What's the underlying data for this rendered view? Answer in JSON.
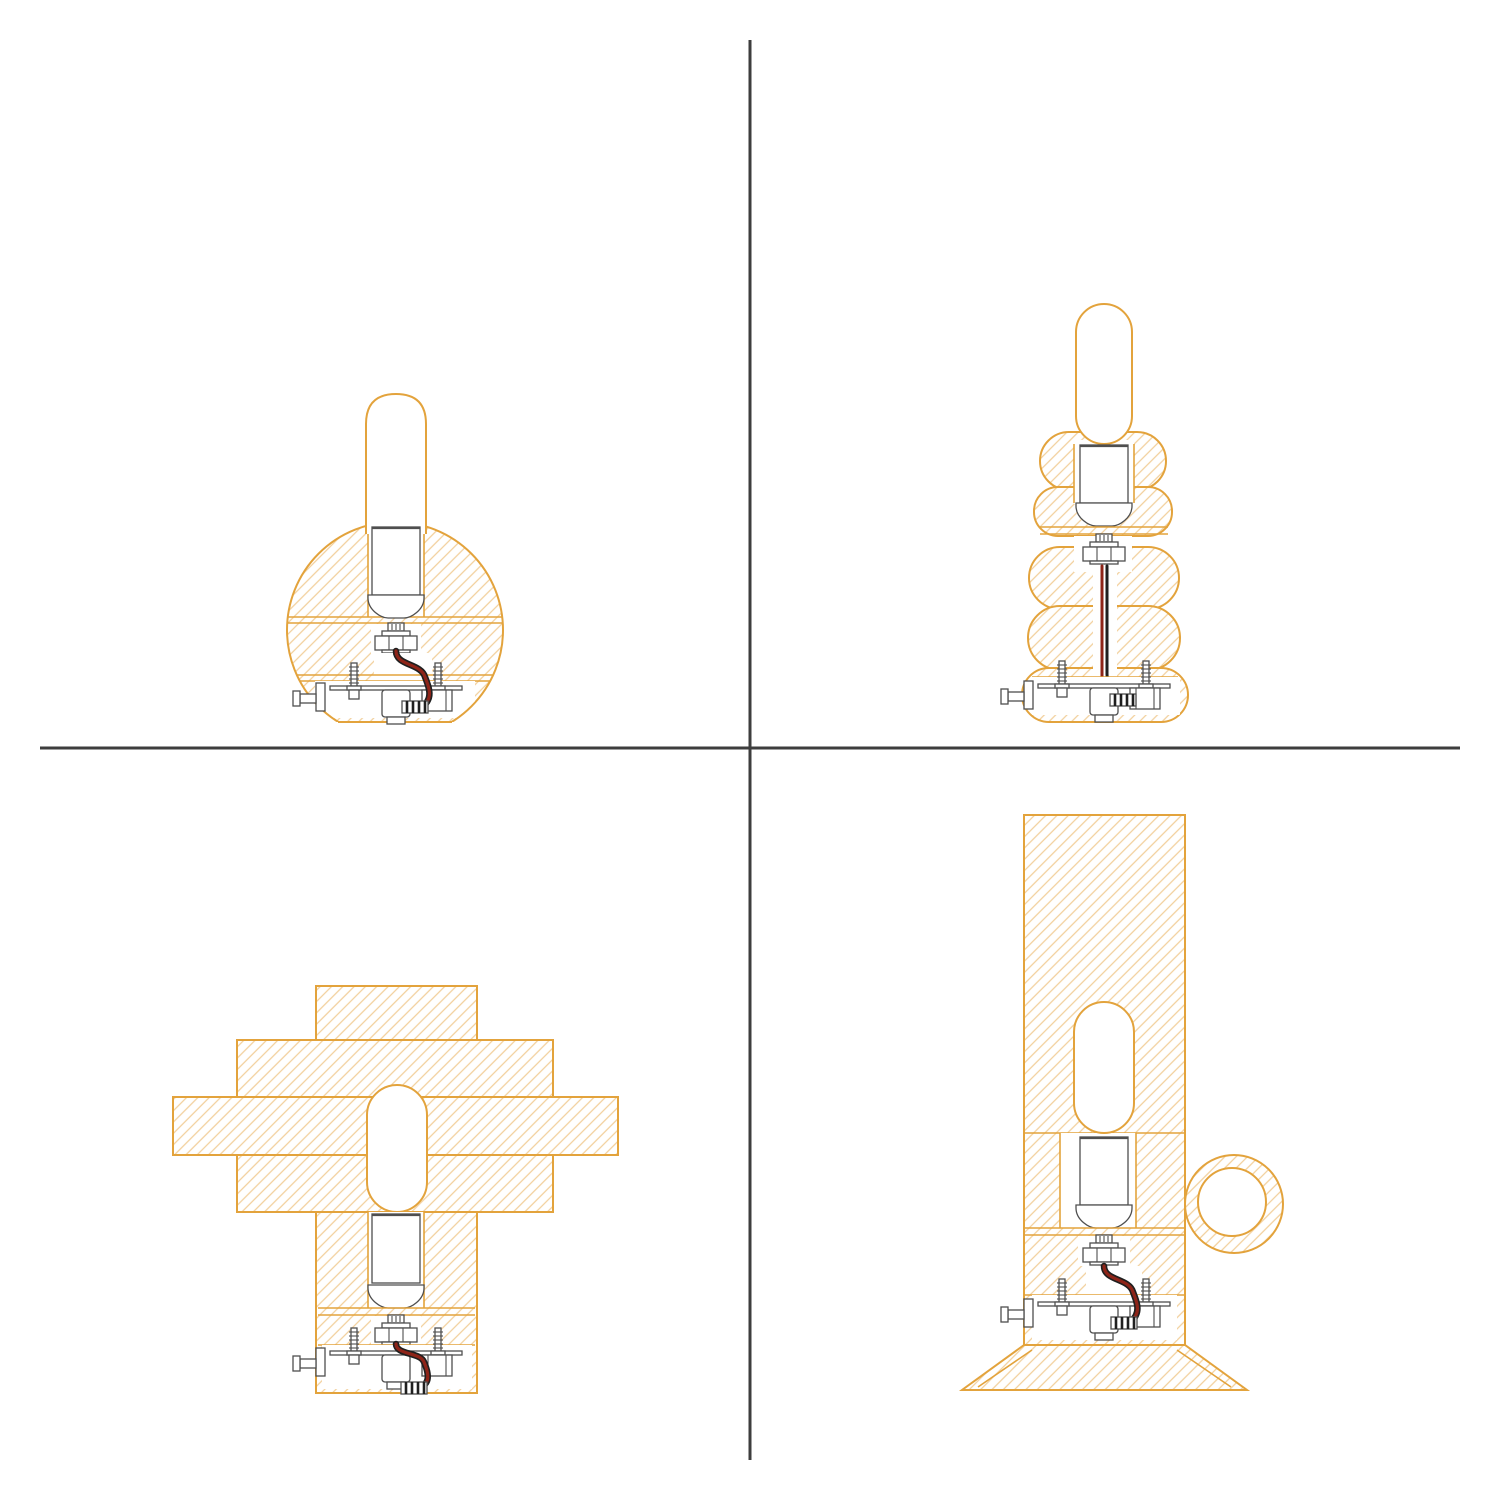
{
  "figure": {
    "kind": "technical-section-drawings",
    "grid": {
      "rows": 2,
      "cols": 2,
      "divider_x": 750,
      "divider_y": 748,
      "divider_extent": {
        "x1": 40,
        "y1": 40,
        "x2": 1460,
        "y2": 1460
      }
    },
    "palette": {
      "background": "#FFFFFF",
      "outline_orange": "#E3A33C",
      "hatch_orange": "#F2CF9B",
      "machinery_gray": "#4F4F4F",
      "wire_red": "#8E2418",
      "wire_black": "#1F1F1F",
      "divider_gray": "#3E3E3E"
    },
    "panels": [
      {
        "id": "top-left",
        "body_shape": "sphere-flat-bottom",
        "elements": [
          "tube-bulb",
          "bulb-socket",
          "hex-nut",
          "power-wire",
          "base-plate-assembly"
        ]
      },
      {
        "id": "top-right",
        "body_shape": "stacked-bubble-segments",
        "segments": 5,
        "elements": [
          "tube-bulb",
          "bulb-socket",
          "hex-nut",
          "power-wire",
          "base-plate-assembly"
        ]
      },
      {
        "id": "bottom-left",
        "body_shape": "stepped-cross-slabs",
        "slabs": 4,
        "elements": [
          "tube-bulb",
          "bulb-socket",
          "hex-nut",
          "power-wire",
          "base-plate-assembly"
        ]
      },
      {
        "id": "bottom-right",
        "body_shape": "cylinder-ring-handle-flared-base",
        "elements": [
          "tube-bulb",
          "bulb-socket",
          "hex-nut",
          "power-wire",
          "base-plate-assembly",
          "ring-handle",
          "flared-foot"
        ]
      }
    ]
  }
}
